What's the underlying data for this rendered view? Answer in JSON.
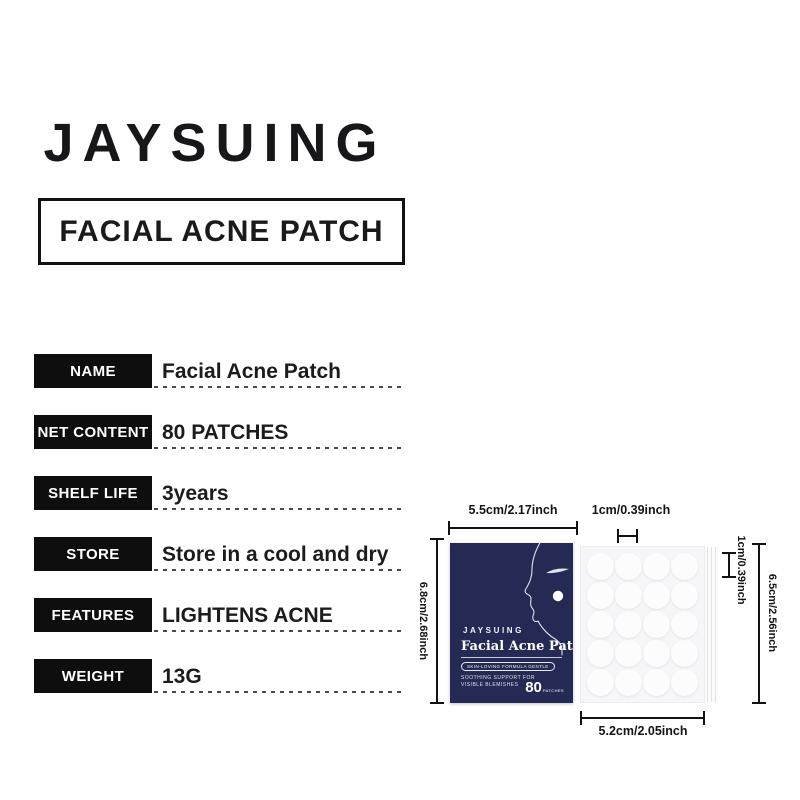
{
  "brand": {
    "logo": "JAYSUING"
  },
  "heading": {
    "title": "FACIAL ACNE PATCH"
  },
  "specs": [
    {
      "label": "NAME",
      "value": "Facial Acne Patch"
    },
    {
      "label": "NET CONTENT",
      "value": "80 PATCHES"
    },
    {
      "label": "SHELF LIFE",
      "value": "3years"
    },
    {
      "label": "STORE",
      "value": "Store in a cool and dry"
    },
    {
      "label": "FEATURES",
      "value": "LIGHTENS ACNE"
    },
    {
      "label": "WEIGHT",
      "value": "13G"
    }
  ],
  "diagram": {
    "box_width_label": "5.5cm/2.17inch",
    "box_height_label": "6.8cm/2.68inch",
    "patch_size_top_label": "1cm/0.39inch",
    "patch_size_right_label": "1cm/0.39inch",
    "sheet_height_label": "6.5cm/2.56inch",
    "sheet_width_label": "5.2cm/2.05inch",
    "package": {
      "brand": "JAYSUING",
      "product_name": "Facial Acne Patch",
      "badge": "SKIN-LOVING FORMULA GENTLE",
      "tagline_line1": "SOOTHING SUPPORT FOR",
      "tagline_line2": "VISIBLE BLEMISHES",
      "count": "80",
      "count_unit": "PATCHES",
      "color": "#252a54"
    },
    "sheet": {
      "rows": 5,
      "cols": 4,
      "color": "#f6f6f8"
    }
  },
  "palette": {
    "label_box": "#0e0e0e",
    "text": "#1c1c1c",
    "package_navy": "#252a54"
  }
}
